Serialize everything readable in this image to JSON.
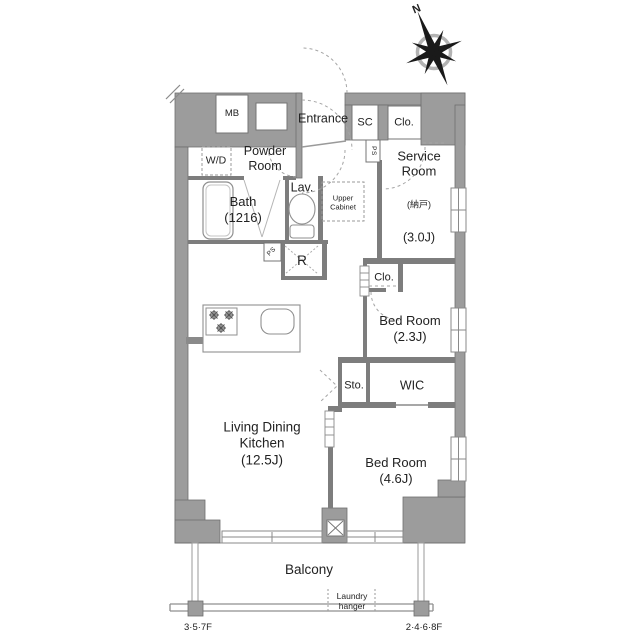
{
  "compass": {
    "north_label": "N"
  },
  "rooms": {
    "mb": {
      "label": "MB"
    },
    "entrance": {
      "label": "Entrance"
    },
    "shoe_closet": {
      "label": "SC"
    },
    "closet_top": {
      "label": "Clo."
    },
    "washer_dryer": {
      "label": "W/D"
    },
    "powder_room": {
      "label": "Powder\nRoom"
    },
    "bath": {
      "label": "Bath\n(1216)"
    },
    "lavatory": {
      "label": "Lav."
    },
    "upper_cabinet": {
      "label": "Upper\nCabinet"
    },
    "pipe_space_top": {
      "label": "PS"
    },
    "pipe_space_mid": {
      "label": "PS"
    },
    "refrigerator_space": {
      "label": "R"
    },
    "service_room": {
      "name": "Service\nRoom",
      "sub": "(納戸)",
      "size": "(3.0J)"
    },
    "closet_bedroom2": {
      "label": "Clo."
    },
    "bedroom_2": {
      "label": "Bed Room\n(2.3J)"
    },
    "storage": {
      "label": "Sto."
    },
    "walk_in_closet": {
      "label": "WIC"
    },
    "bedroom_4": {
      "label": "Bed Room\n(4.6J)"
    },
    "living_dining_kitchen": {
      "label": "Living Dining\nKitchen\n(12.5J)"
    },
    "balcony": {
      "label": "Balcony"
    }
  },
  "annotations": {
    "laundry_hanger": "Laundry\nhanger",
    "floor_left": "3·5·7F",
    "floor_right": "2·4·6·8F"
  },
  "colors": {
    "wall_fill": "#9c9c9c",
    "wall_edge": "#6f6f6f",
    "thin_wall": "#7d7d7d",
    "fixture_line": "#8f8f8f",
    "dashed_line": "#a5a5a5",
    "text": "#222222"
  }
}
